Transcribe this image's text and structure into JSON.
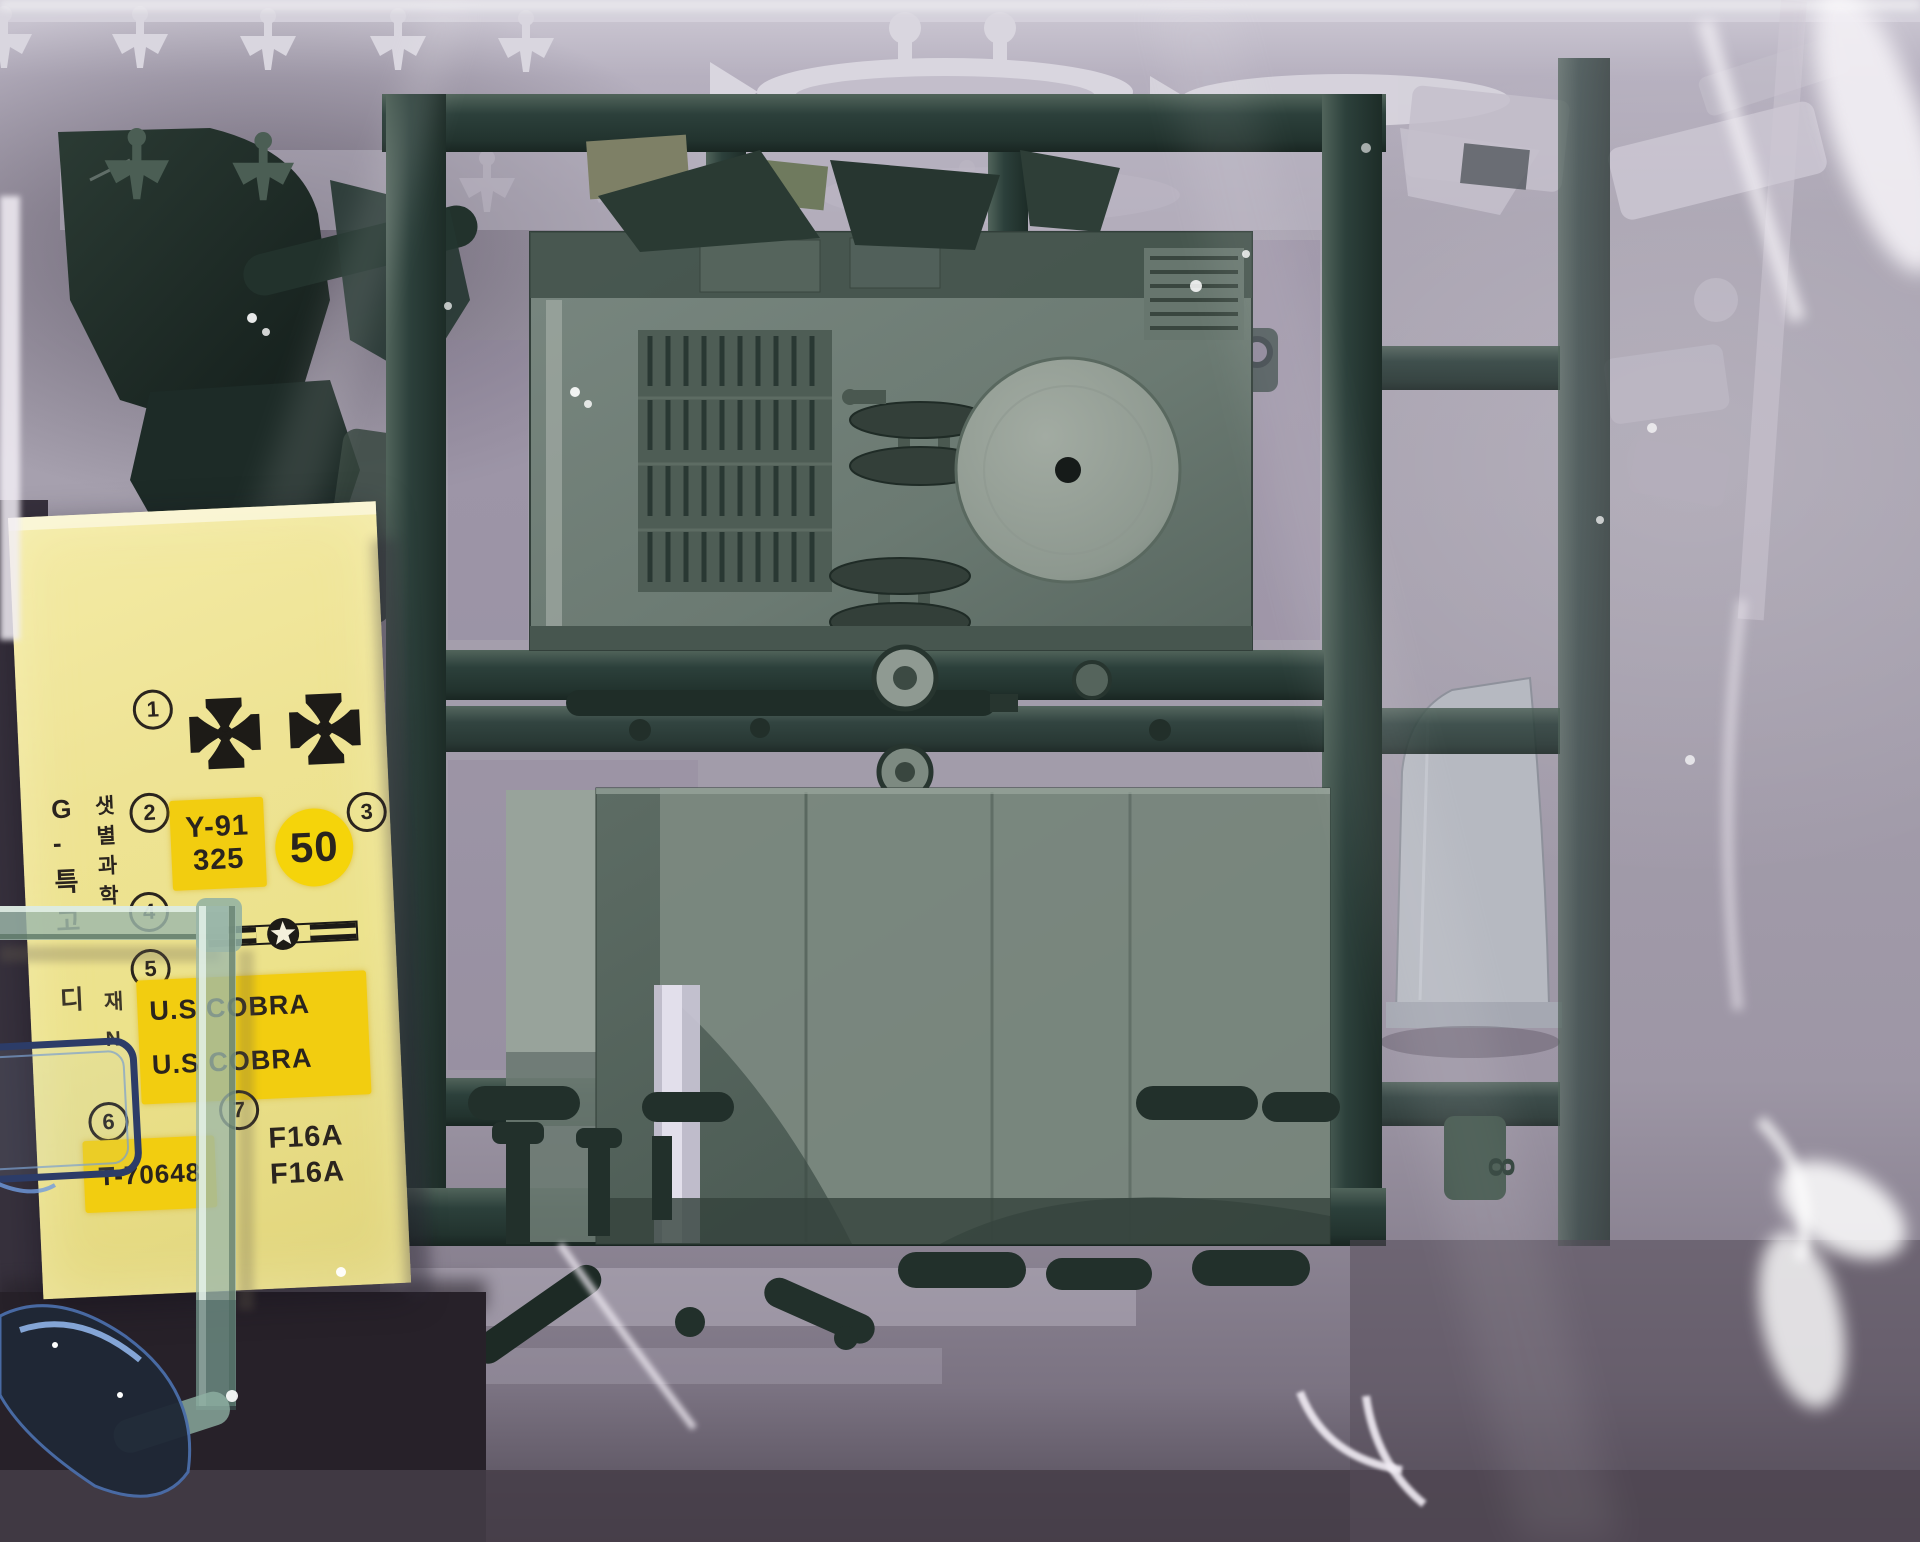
{
  "photo": {
    "alt": "Plastic scale-model kit sprues sealed in clear shrink wrap with a yellow decal sheet"
  },
  "decal": {
    "markers": {
      "m1": "1",
      "m2": "2",
      "m3": "3",
      "m4": "4",
      "m5": "5",
      "m6": "6",
      "m7": "7"
    },
    "code_top": "Y-91",
    "code_bottom": "325",
    "number_50": "50",
    "cobra_line1": "U.S COBRA",
    "cobra_line2": "U.S COBRA",
    "serial": "T-70648",
    "f16_line1": "F16A",
    "f16_line2": "F16A",
    "korean_left": [
      "G",
      "-",
      "특",
      "고",
      "디"
    ],
    "korean_right": [
      "샛",
      "별",
      "과",
      "학",
      "재",
      "N"
    ]
  },
  "sprue": {
    "tag_number": "8"
  },
  "colors": {
    "wrap": "#a8a2b0",
    "sprue_green": "#2c403b",
    "part_gray_green": "#6e7d76",
    "white_sprue": "#d9d6df",
    "clear_part_tint": "#9db8ab",
    "canopy_outline": "#2c3c68",
    "decal_paper": "#ece28b",
    "decal_highlight": "#f2cd10",
    "decal_ink": "#2a241e"
  }
}
